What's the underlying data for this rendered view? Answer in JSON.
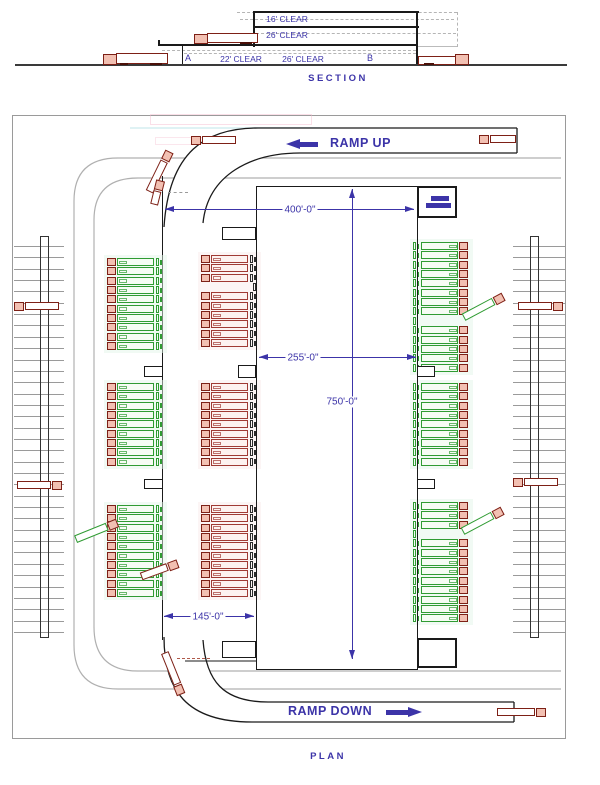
{
  "section": {
    "title": "SECTION",
    "labels": {
      "clear16": "16' CLEAR",
      "clear26_upper": "26' CLEAR",
      "bay_a": "A",
      "clear22": "22' CLEAR",
      "clear26_lower": "26' CLEAR",
      "bay_b": "B"
    }
  },
  "plan": {
    "title": "PLAN",
    "ramp_up_label": "RAMP UP",
    "ramp_down_label": "RAMP DOWN",
    "dimensions": {
      "overall_width": "400'-0\"",
      "core_width": "255'-0\"",
      "core_length": "750'-0\"",
      "apron_width": "145'-0\""
    }
  },
  "colors": {
    "dimension_purple": "#3c34a8",
    "truck_red": "#7d2016",
    "stall_red_border": "#a03a34",
    "stall_green_border": "#2f9b32",
    "drive_lane_gray": "#b0b0b0",
    "structure_black": "#1a1a1a",
    "cab_pink": "#f2c0b2"
  },
  "features": {
    "stall_pitch": 9.35,
    "stall_groups": [
      {
        "x": 107,
        "y": 258,
        "count": 10,
        "gaps": [],
        "type": "green",
        "facing": "left"
      },
      {
        "x": 107,
        "y": 383,
        "count": 9,
        "gaps": [],
        "type": "green",
        "facing": "left"
      },
      {
        "x": 107,
        "y": 505,
        "count": 10,
        "gaps": [],
        "type": "green",
        "facing": "left"
      },
      {
        "x": 201,
        "y": 255,
        "count": 10,
        "gaps": [
          3
        ],
        "type": "red",
        "facing": "left"
      },
      {
        "x": 201,
        "y": 383,
        "count": 9,
        "gaps": [],
        "type": "red",
        "facing": "left"
      },
      {
        "x": 201,
        "y": 505,
        "count": 10,
        "gaps": [],
        "type": "red",
        "facing": "left"
      },
      {
        "x": 413,
        "y": 242,
        "count": 14,
        "gaps": [
          8
        ],
        "type": "green",
        "facing": "right"
      },
      {
        "x": 413,
        "y": 383,
        "count": 9,
        "gaps": [],
        "type": "green",
        "facing": "right"
      },
      {
        "x": 413,
        "y": 502,
        "count": 13,
        "gaps": [
          3
        ],
        "type": "green",
        "facing": "right"
      }
    ],
    "ladders": [
      {
        "x": 14,
        "y": 236,
        "w": 50,
        "h": 402,
        "rail_off": 26,
        "rail_w": 9
      },
      {
        "x": 513,
        "y": 236,
        "w": 52,
        "h": 402,
        "rail_off": 17,
        "rail_w": 9
      }
    ],
    "straight_trucks": [
      {
        "x": 14,
        "y": 301,
        "facing": "left"
      },
      {
        "x": 16,
        "y": 480,
        "facing": "right"
      },
      {
        "x": 517,
        "y": 301,
        "facing": "right"
      },
      {
        "x": 513,
        "y": 477,
        "facing": "left"
      },
      {
        "x": 191,
        "y": 135,
        "facing": "left"
      },
      {
        "x": 479,
        "y": 134,
        "facing": "left",
        "w": 38
      },
      {
        "x": 496,
        "y": 707,
        "facing": "right",
        "w": 50
      }
    ],
    "moving_trucks": [
      {
        "cx": 159,
        "cy": 172,
        "rot": -64,
        "color": "red"
      },
      {
        "cx": 157,
        "cy": 193,
        "rot": -76,
        "color": "red",
        "w": 26
      },
      {
        "cx": 483,
        "cy": 307,
        "rot": -28,
        "color": "green"
      },
      {
        "cx": 482,
        "cy": 521,
        "rot": -28,
        "color": "green"
      },
      {
        "cx": 96,
        "cy": 531,
        "rot": -22,
        "color": "green"
      },
      {
        "cx": 159,
        "cy": 570,
        "rot": -20,
        "color": "red",
        "w": 40
      },
      {
        "cx": 173,
        "cy": 673,
        "rot": 68,
        "color": "red"
      }
    ],
    "notches": [
      {
        "x": 222,
        "y": 227,
        "w": 34,
        "h": 13
      },
      {
        "x": 238,
        "y": 365,
        "w": 18,
        "h": 13
      },
      {
        "x": 417,
        "y": 366,
        "w": 18,
        "h": 11
      },
      {
        "x": 417,
        "y": 479,
        "w": 18,
        "h": 10
      },
      {
        "x": 144,
        "y": 366,
        "w": 19,
        "h": 11
      },
      {
        "x": 144,
        "y": 479,
        "w": 19,
        "h": 10
      },
      {
        "x": 222,
        "y": 641,
        "w": 34,
        "h": 17
      }
    ],
    "dashes": [
      {
        "x": 168,
        "y": 192,
        "w": 20,
        "color": "#9a9a9a"
      },
      {
        "x": 177,
        "y": 658,
        "w": 33,
        "color": "#b05a4a"
      }
    ]
  }
}
